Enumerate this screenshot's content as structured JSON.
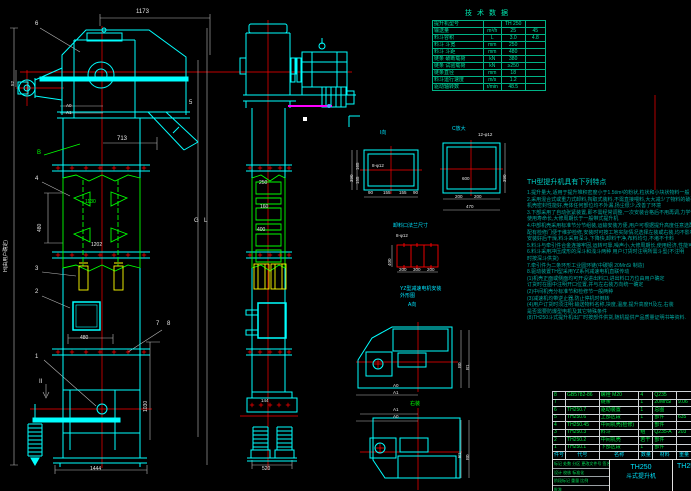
{
  "colors": {
    "cyan": "#00ffff",
    "green": "#00ff00",
    "red": "#ff0000",
    "yellow": "#ffff00",
    "magenta": "#ff00ff",
    "teal": "#00c9a3"
  },
  "labels": {
    "d1173": "1173",
    "d713": "713",
    "n6": "6",
    "n5": "5",
    "n4": "4",
    "n3": "3",
    "n2": "2",
    "n1": "1",
    "n7": "7",
    "n8": "8",
    "bB": "B",
    "mII": "II",
    "d52": "52",
    "d480": "480",
    "d1130": "1130",
    "d1202": "1202",
    "d1030": "1030",
    "d1444": "1444",
    "dH": "H(由用户确定)",
    "lG": "G",
    "lL": "L",
    "a0": "A0",
    "a1": "A1",
    "b0": "B0",
    "b1": "B1",
    "d250": "250",
    "d160": "160",
    "d400": "400",
    "d144": "144",
    "d520": "520",
    "iview": "I向",
    "cview": "C放大",
    "f1holes": "8-φ12",
    "f2holes": "12-φ12",
    "d165": "165",
    "d155": "155",
    "d90": "90",
    "d600": "600",
    "d200": "200",
    "d300": "300",
    "d470": "470",
    "d390": "390",
    "outlet": "卸料口法兰尺寸",
    "yz1": "YZ型减速电机安装",
    "yz2": "外形图",
    "aview": "A向",
    "rz": "右装"
  },
  "tech_table": {
    "title": "技术数据",
    "rows": [
      {
        "c1": "提升机型号",
        "c2": "",
        "c3": "TH 250",
        "c4": ""
      },
      {
        "c1": "输送量",
        "c2": "m³/h",
        "c3": "25",
        "c4": "45"
      },
      {
        "c1": "料斗容积",
        "c2": "L",
        "c3": "3.0",
        "c4": "4.8"
      },
      {
        "c1": "料斗 斗宽",
        "c2": "mm",
        "c3": "250",
        "c4": ""
      },
      {
        "c1": "料斗 斗距",
        "c2": "mm",
        "c3": "480",
        "c4": ""
      },
      {
        "c1": "链条 破断载荷",
        "c2": "kN",
        "c3": "380",
        "c4": ""
      },
      {
        "c1": "链条 试验载荷",
        "c2": "kN",
        "c3": "≥250",
        "c4": ""
      },
      {
        "c1": "链条直径",
        "c2": "mm",
        "c3": "18",
        "c4": ""
      },
      {
        "c1": "料斗运行速度",
        "c2": "m/s",
        "c3": "1.2",
        "c4": ""
      },
      {
        "c1": "驱动轴转数",
        "c2": "r/min",
        "c3": "48.5",
        "c4": ""
      }
    ]
  },
  "notes": {
    "title": "TH型提升机具有下列特点",
    "lines": [
      "1.提升量大,适用于提升堆积密度小于1.5t/m³的粉状,粒状和小块状物料一般",
      "2.采用混合式或重力式卸料,掏取式装料,不需直接喂料,大大减少了物料的破碎,适用于一般磨琢性物料",
      "   机壳密封性能好,壳体任何部位均不外漏,扬尘很少,改善了环境",
      "3.下部采用了自动张紧装置,即不需经常调整,一次安装合格后不用再调,力学性能好,运行平稳",
      "   使用寿命长,大修周期长于一般带式提升机",
      "4.中部机壳采用标准节分节组装,运输安装方便,用户可根据提升高度任意选配,机壳密封性能好",
      "   配有检修门便于维护检修,安装时可按工地实际情况选择左装或右装,均不影响使用功能",
      "   安装好后干燥,料斗采用深斗,下降快,卸料干净,布料均匀,不堵不卡料",
      "5.料斗与牵引件合金连接牢固,运转可靠,噪声小,大修周期长,使用经济,性能可靠,维修方便",
      "6.料斗采用冲压成形的深斗和浅斗两种                    用户订货时注明所需斗型(不注明",
      "   时按深斗供货)",
      "7.牵引件为二条环形工业圆环链(中碳钢 20MnSi 制造)",
      "8.驱动装置TH型采用YZ系列减速电机直联传动",
      "",
      "",
      "(1)机壳正面或侧面均可开设进出料口,进出料口方位由用户确定",
      "   订货时在图中注明开口位置,并与左右装方向统一确定",
      "(2)中间机壳分标准节和检修节一般两种",
      "(3)减速机均带逆止器,防止停机时倒转",
      "(4)用户订货时须注明:输送物料名称,块度,温度,提升高度H及左,右装",
      "   是否需要防爆型电机及其它特殊条件",
      "",
      "",
      "(8)TH250斗式提升机出厂时按部件供货,随机提供产品质量证明书等资料."
    ]
  },
  "parts_table": {
    "rows": [
      {
        "no": "8",
        "code": "GB5782-86",
        "name": "螺栓 M20",
        "qty": "4",
        "mat": "Q235",
        "wt": "",
        "rm": ""
      },
      {
        "no": "7",
        "code": "",
        "name": "链条",
        "qty": "1",
        "mat": "20MnSi",
        "wt": "9.06",
        "rm": ""
      },
      {
        "no": "6",
        "code": "TH250.7",
        "name": "驱动装置",
        "qty": "1",
        "mat": "总图",
        "wt": "",
        "rm": ""
      },
      {
        "no": "5",
        "code": "TH250.6",
        "name": "上部区段",
        "qty": "1",
        "mat": "部件",
        "wt": "635",
        "rm": ""
      },
      {
        "no": "4",
        "code": "TH250.45",
        "name": "中间机壳(检修)",
        "qty": "",
        "mat": "部件",
        "wt": "",
        "rm": ""
      },
      {
        "no": "3",
        "code": "TH250.3",
        "name": "料斗",
        "qty": "组",
        "mat": "Q235-A",
        "wt": "203",
        "rm": ""
      },
      {
        "no": "2",
        "code": "TH250.2",
        "name": "中间机壳",
        "qty": "若干",
        "mat": "部件",
        "wt": "",
        "rm": ""
      },
      {
        "no": "1",
        "code": "TH250.1",
        "name": "下部区段",
        "qty": "1",
        "mat": "部件",
        "wt": "",
        "rm": ""
      }
    ],
    "header": [
      "件号",
      "代号",
      "名称",
      "数量",
      "材料",
      "重量",
      "备注"
    ]
  },
  "title_block": {
    "model": "TH250",
    "product": "斗式提升机",
    "drawing_no": "TH250",
    "left_rows": [
      "标记 处数 分区 更改文件号 签名 日期",
      "设计  校核  标准化",
      "阶段标记  重量  比例",
      "批准"
    ]
  }
}
